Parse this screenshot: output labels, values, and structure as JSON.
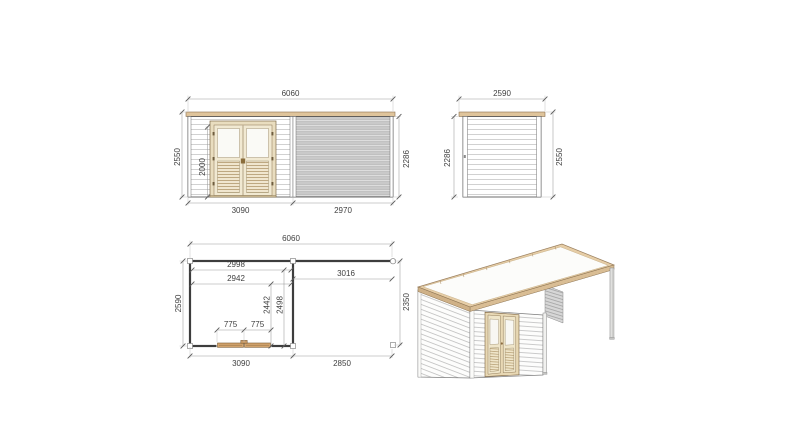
{
  "sheet": {
    "background": "#ffffff",
    "description_label": "garden cabin with canopy technical drawing"
  },
  "views": {
    "front_elevation": {
      "dims": {
        "total_width": "6060",
        "total_height": "2550",
        "door_height": "2000",
        "wall_height": "2286",
        "cabin_width": "3090",
        "canopy_width": "2970"
      }
    },
    "side_elevation": {
      "dims": {
        "total_width": "2590",
        "wall_height": "2286",
        "total_height": "2550"
      }
    },
    "floor_plan": {
      "dims": {
        "total_width": "6060",
        "inner_width_a": "2998",
        "inner_width_b": "2942",
        "canopy_inner_width": "3016",
        "total_depth": "2590",
        "door_pos_a": "2442",
        "door_pos_b": "2498",
        "canopy_depth": "2350",
        "door_leaf_left": "775",
        "door_leaf_right": "775",
        "cabin_width": "3090",
        "canopy_width": "2850"
      }
    },
    "perspective": {
      "label": "3d-view"
    }
  },
  "colors": {
    "roof_trim_wood": "#dfc49b",
    "roof_fascia_wood": "#d9bd94",
    "door_frame_wood": "#e9ddbf",
    "plan_door_wood": "#d2a36c",
    "slat_gray": "#c9c9c9",
    "siding_line_gray": "#ababab",
    "outline_dark": "#4a4a4a",
    "dimension_text": "#3f3f3f",
    "dimension_line": "#9a9a9a"
  }
}
